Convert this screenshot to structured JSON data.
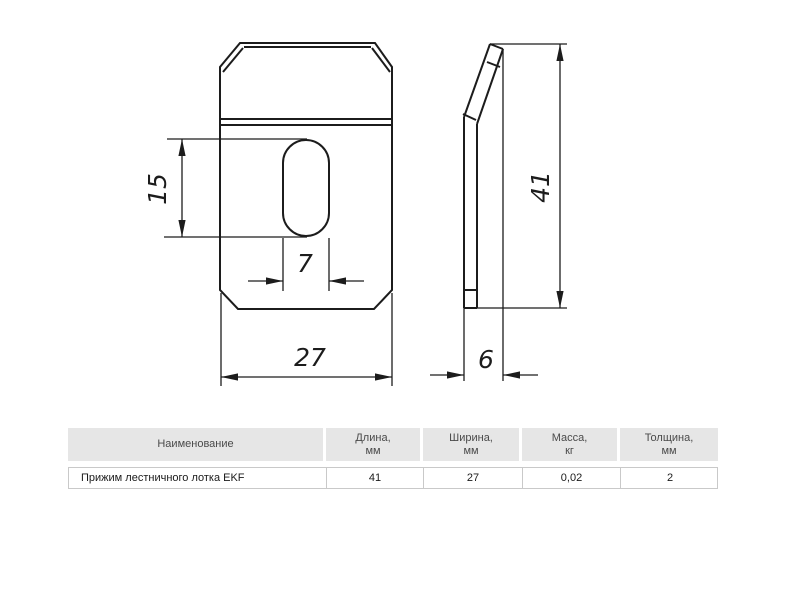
{
  "drawing": {
    "front_view": {
      "dim_slot_length": "15",
      "dim_slot_width": "7",
      "dim_width": "27"
    },
    "side_view": {
      "dim_height": "41",
      "dim_depth": "6"
    }
  },
  "table": {
    "headers": [
      {
        "line1": "Наименование",
        "line2": ""
      },
      {
        "line1": "Длина,",
        "line2": "мм"
      },
      {
        "line1": "Ширина,",
        "line2": "мм"
      },
      {
        "line1": "Масса,",
        "line2": "кг"
      },
      {
        "line1": "Толщина,",
        "line2": "мм"
      }
    ],
    "row": {
      "name": "Прижим лестничного лотка EKF",
      "length": "41",
      "width": "27",
      "mass": "0,02",
      "thickness": "2"
    }
  },
  "colors": {
    "line": "#1c1c1c",
    "header_bg": "#e6e6e6",
    "header_text": "#4a4a4a",
    "border": "#c9c9c9"
  }
}
